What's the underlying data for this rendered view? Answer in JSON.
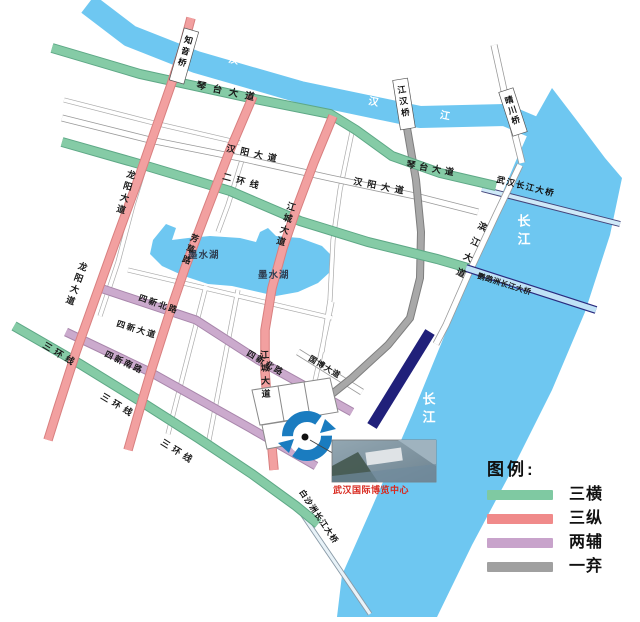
{
  "colors": {
    "river_blue": "#6ec7f1",
    "green_road": "#85cba6",
    "red_road": "#f2a0a0",
    "purple_road": "#cbaacd",
    "gray_road": "#a8a8a8",
    "notice_band": "#20207a",
    "roundabout_blue": "#1a7cc0",
    "caption_red": "#d8281e"
  },
  "map": {
    "rivers": {
      "han_river": "汉 江",
      "yangtze": "长江"
    },
    "lake": {
      "name": "墨水湖"
    },
    "roads": {
      "qintai": "琴台大道",
      "erhuan": "二环线",
      "sanhuan": "三环线",
      "longyang": "龙阳大道",
      "fangcao": "芳草路",
      "jiangcheng": "江城大道",
      "sixin_north": "四新北路",
      "sixin_south": "四新南路",
      "sixin_avenue": "四新大道",
      "guobo": "国博大道",
      "hanyang": "汉阳大道",
      "binjiang": "滨江大道"
    },
    "bridges": {
      "zhiyin": "知音桥",
      "jianghan": "江汉桥",
      "qingchuan": "晴川桥",
      "wuhan_changjiang": "武汉长江大桥",
      "yingwuzhou": "鹦鹉洲长江大桥",
      "baishazhou": "白沙洲长江大桥"
    },
    "notice": "此路段未通",
    "expo": {
      "caption": "武汉国际博览中心"
    }
  },
  "legend": {
    "title": "图例:",
    "items": [
      {
        "label": "三横",
        "color": "#7fc9a2"
      },
      {
        "label": "三纵",
        "color": "#f08a8a"
      },
      {
        "label": "两辅",
        "color": "#c8a3cb"
      },
      {
        "label": "一弃",
        "color": "#a0a0a0"
      }
    ]
  }
}
